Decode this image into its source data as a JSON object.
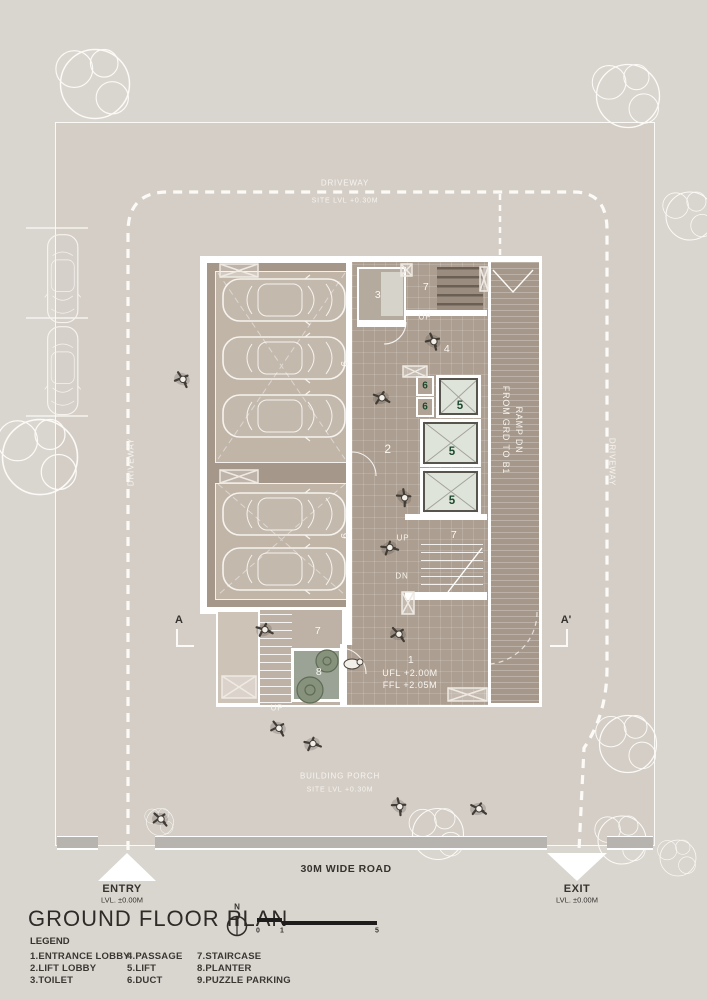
{
  "colors": {
    "page_bg": "#d9d5cf",
    "site_bg": "#d4cec7",
    "building_floor": "#ac9e90",
    "parking_bay": "#c1b5a8",
    "parking_border": "#a5978a",
    "lift_fill": "#dfe4db",
    "planter_fill": "#9ba396",
    "accent_green": "#1c4a2c",
    "wall_white": "#ffffff",
    "text_dark": "#36332f",
    "text_white": "#f9f7f2"
  },
  "site": {
    "driveway_top": "DRIVEWAY",
    "driveway_top_sub": "SITE LVL +0.30M",
    "driveway_left": "DRIVEWAY",
    "driveway_right": "DRIVEWAY",
    "porch": "BUILDING PORCH",
    "porch_sub": "SITE LVL +0.30M",
    "road": "30M WIDE ROAD",
    "entry_label": "ENTRY",
    "entry_level": "LVL. ±0.00M",
    "exit_label": "EXIT",
    "exit_level": "LVL. ±0.00M",
    "section_a": "A",
    "section_a2": "A'"
  },
  "plan": {
    "toilet": "3",
    "stair_top": "7",
    "stair_top_up": "UP",
    "passage": "4",
    "lift_lobby": "2",
    "duct_1": "6",
    "duct_2": "6",
    "lift_1": "5",
    "lift_2": "5",
    "lift_3": "5",
    "stair_mid": "7",
    "stair_mid_up": "UP",
    "stair_mid_dn": "DN",
    "stair_low": "7",
    "porch_up": "UP",
    "planter": "8",
    "entrance": "1",
    "entrance_ufl": "UFL +2.00M",
    "entrance_ffl": "FFL +2.05M",
    "parking_upper": "9",
    "parking_lower": "9",
    "ramp_line1": "RAMP DN",
    "ramp_line2": "FROM GRD TO B1"
  },
  "title_block": {
    "title": "GROUND FLOOR PLAN",
    "north": "N",
    "scale_0": "0",
    "scale_1": "1",
    "scale_5": "5",
    "legend_title": "LEGEND",
    "legend": [
      [
        "1.ENTRANCE LOBBY",
        "2.LIFT LOBBY",
        "3.TOILET"
      ],
      [
        "4.PASSAGE",
        "5.LIFT",
        "6.DUCT"
      ],
      [
        "7.STAIRCASE",
        "8.PLANTER",
        "9.PUZZLE PARKING"
      ]
    ]
  }
}
